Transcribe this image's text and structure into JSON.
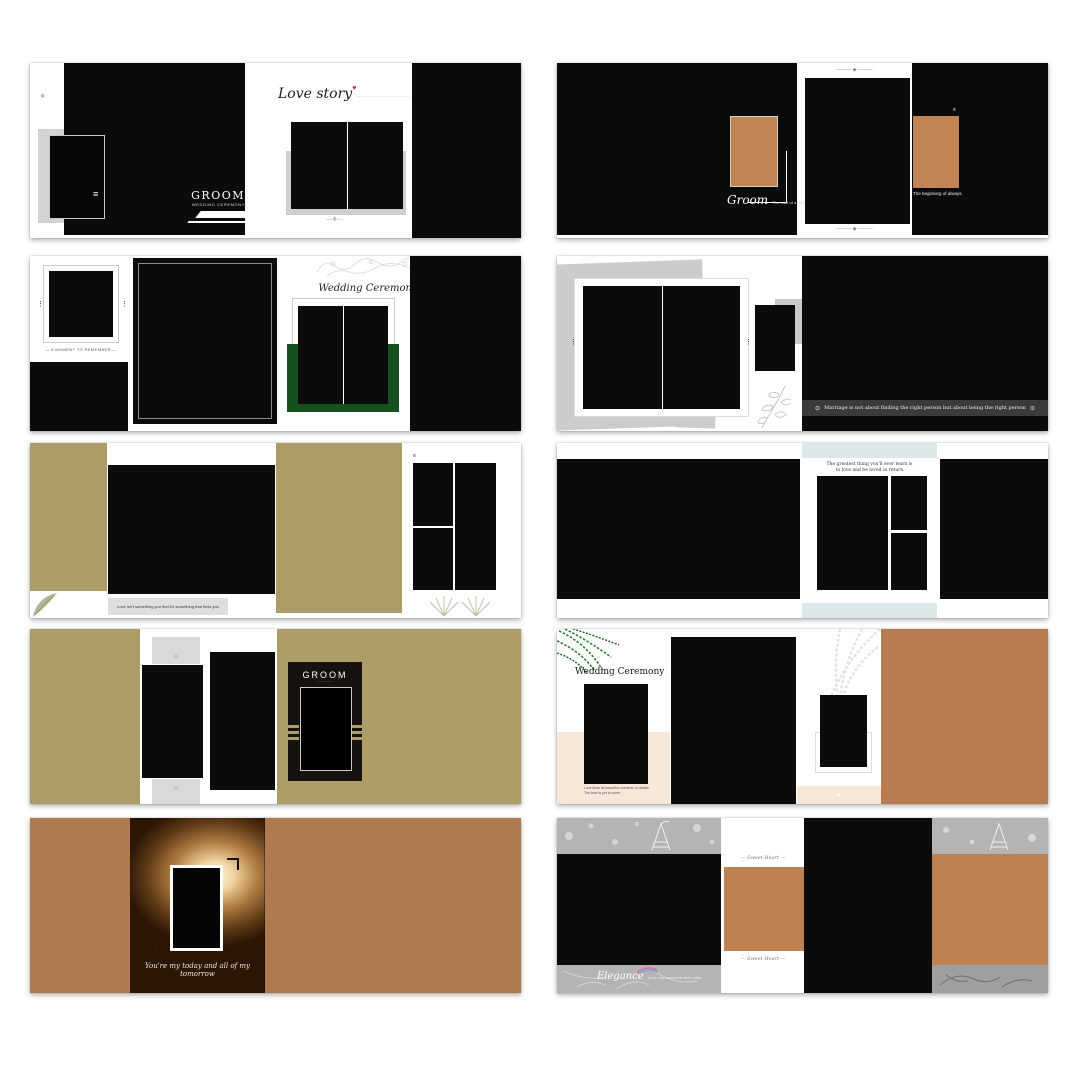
{
  "page": {
    "title": "Wedding album template preview grid",
    "background": "#ffffff"
  },
  "colors": {
    "olive": "#ac9c68",
    "copper": "#b07a50",
    "tan_photo": "#c08552",
    "tan_right": "#b87a4e",
    "tan_light": "#bf8150",
    "green_block": "#17501f",
    "blush": "#f6e7d8",
    "light_blue": "#dbe7e9",
    "gray_band": "#b4b4b4",
    "gray_mat": "#d3d3d3",
    "quote_bar": "#3a3a3a",
    "accent_red": "#cf2418"
  },
  "panels": {
    "spread1": {
      "groom_title": "GROOM",
      "groom_subtitle": "WEDDING CEREMONY",
      "love_story": "Love story",
      "heart_icon": "♥",
      "dotted_line": "·····················",
      "ornament_left": "❖",
      "grip_icon": "≡",
      "ornament_bottom": "—❖—"
    },
    "spread2": {
      "groom_script": "Groom",
      "groom_caption": "The start of a beautiful forever",
      "ornament_top": "——— ◆ ———",
      "ornament_bottom": "——— ◆ ———",
      "corner_icon": "≡",
      "beginning_caption": "The beginning of always."
    },
    "spread3": {
      "moment_caption": "— A MOMENT  TO REMEMBER —",
      "ceremony_title": "Wedding Ceremony",
      "dots_icon": "⋮"
    },
    "spread4": {
      "dots_icon": "⋮",
      "quote_icon": "⊙",
      "quote": "Marriage is not about finding the right person but about being the right person"
    },
    "spread5": {
      "caption": "Love isn't something you find it's something that finds you",
      "corner_icon": "≡"
    },
    "spread6": {
      "caption_line1": "The greatest thing you'll ever learn is",
      "caption_line2": "to love and be loved in return"
    },
    "spread7": {
      "groom_title": "GROOM",
      "underline": "·············",
      "band_ornament_top": "· ⊙ ·",
      "band_ornament_bottom": "· ⊙ ·"
    },
    "spread8": {
      "title": "Wedding Ceremony",
      "caption_line1": "Love finds its beautiful moments in details",
      "caption_line2": "The best is yet to come",
      "ornament": "◈"
    },
    "spread9": {
      "caption": "You're my today and all of my tomorrow"
    },
    "spread10": {
      "elegance": "Elegance",
      "elegance_caption": "is the only beauty that never fades",
      "ornament_top": "— Sweet Heart —",
      "ornament_bottom": "— Sweet Heart —"
    }
  }
}
